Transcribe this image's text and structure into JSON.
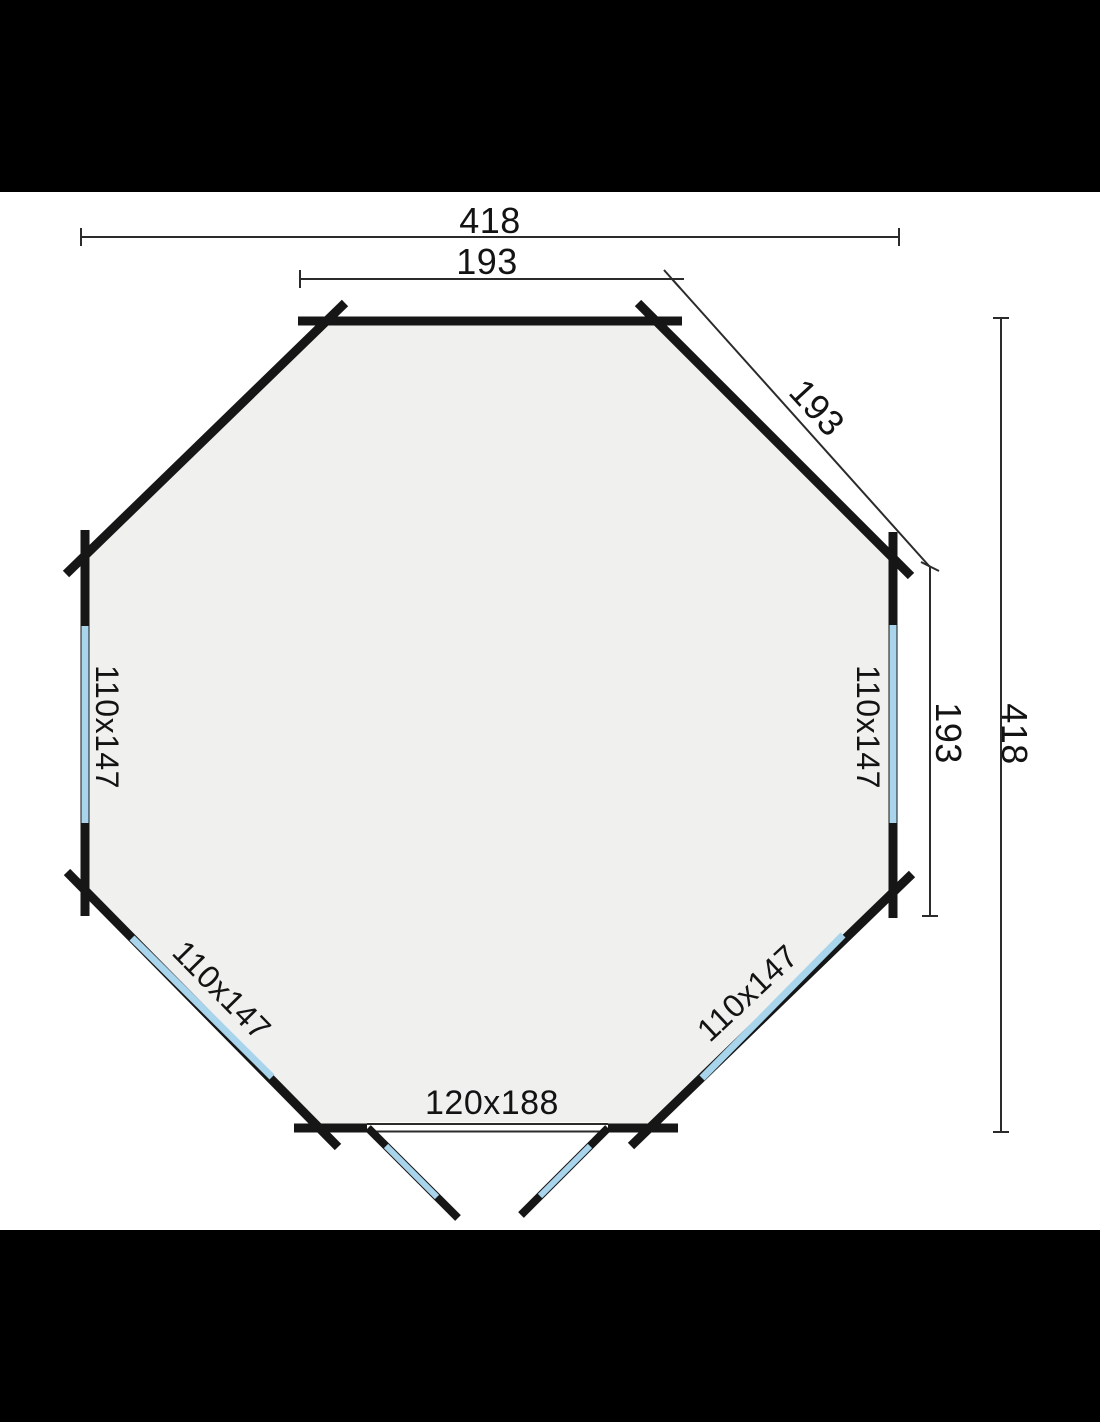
{
  "colors": {
    "letterbox": "#000000",
    "background": "#ffffff",
    "interior_fill": "#f0f0ee",
    "wall": "#161616",
    "window_glass": "#a8d4ec",
    "dimension_line": "#2b2b2b",
    "text": "#131313"
  },
  "labels": {
    "overall_width": "418",
    "front_edge": "193",
    "diagonal_edge": "193",
    "side_edge": "193",
    "overall_depth": "418",
    "window_left": "110x147",
    "window_right": "110x147",
    "window_front_left": "110x147",
    "window_front_right": "110x147",
    "door": "120x188"
  }
}
